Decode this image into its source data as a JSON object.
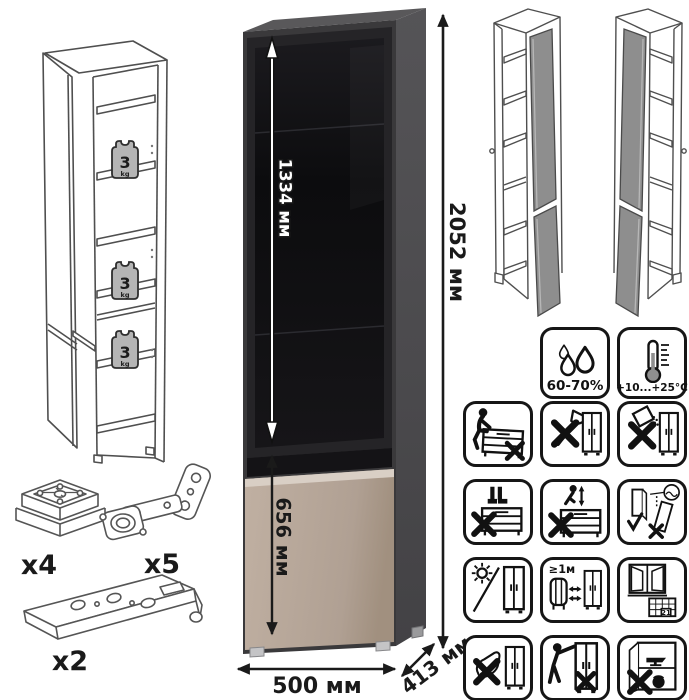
{
  "cabinet": {
    "dimensions": {
      "upper_door_height": "1334 мм",
      "total_height": "2052 мм",
      "lower_door_height": "656 мм",
      "width": "500 мм",
      "depth": "413 мм"
    },
    "colors": {
      "carcass_side": "#4c4b4d",
      "carcass_top": "#59585a",
      "front_frame": "#3a393b",
      "glass_frame": "#252427",
      "glass": "#101013",
      "lower_door": "#b5a496",
      "lower_door_highlight": "#d9cfc5",
      "open_door_gray": "#8e8e8e"
    }
  },
  "shelf_load": {
    "value": "3",
    "unit": "kg"
  },
  "hardware": {
    "foot": {
      "label": "x4"
    },
    "hinge": {
      "label": "x5"
    },
    "rail": {
      "label": "x2"
    }
  },
  "icons": {
    "conditions": [
      {
        "name": "humidity-icon",
        "label": "60-70%"
      },
      {
        "name": "temperature-icon",
        "label": "+10...+25°C"
      }
    ],
    "warnings": [
      {
        "name": "no-sitting-icon"
      },
      {
        "name": "no-sharp-tools-icon"
      },
      {
        "name": "no-spilling-icon"
      },
      {
        "name": "no-standing-icon"
      },
      {
        "name": "no-jumping-icon"
      },
      {
        "name": "carry-panels-upright-icon"
      },
      {
        "name": "no-direct-sunlight-icon"
      },
      {
        "name": "heat-source-distance-icon",
        "label": "≥1м"
      },
      {
        "name": "ventilation-acclimatize-icon",
        "label": "21"
      },
      {
        "name": "no-kicking-icon"
      },
      {
        "name": "no-pushing-icon"
      },
      {
        "name": "no-heavy-items-icon"
      }
    ]
  }
}
